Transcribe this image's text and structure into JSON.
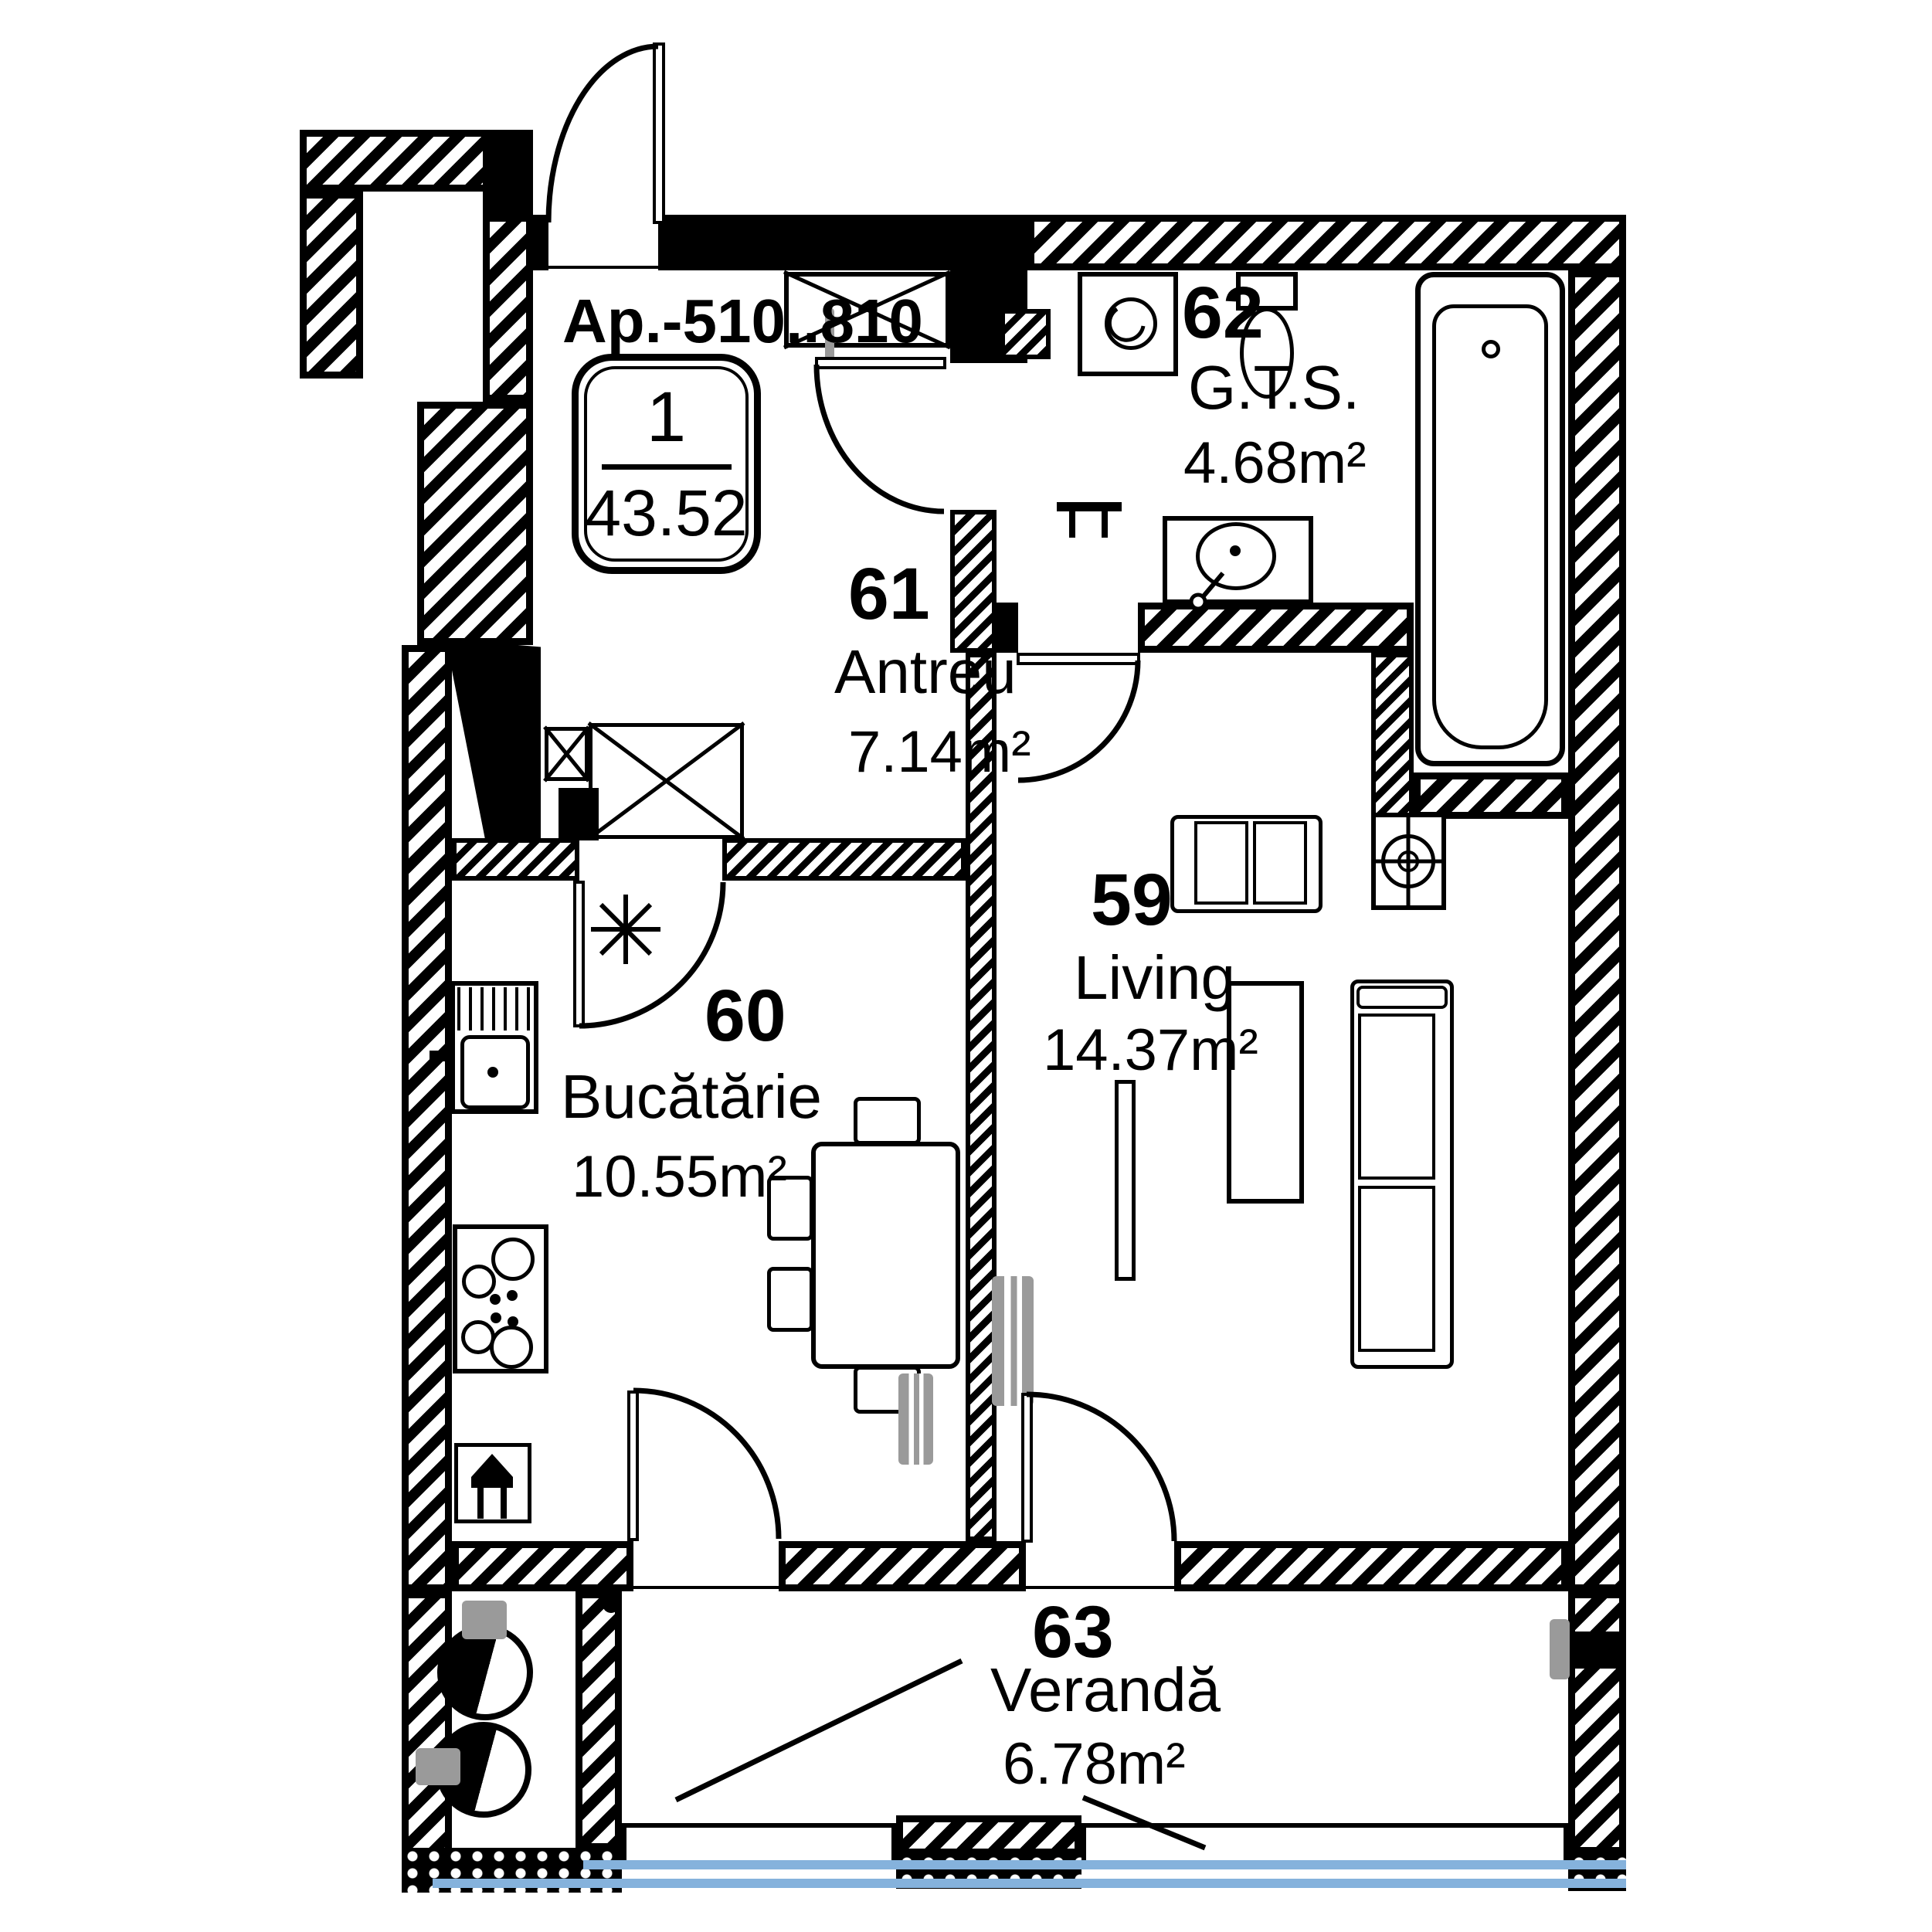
{
  "apartment": {
    "title": "Ap.-510..810",
    "badge_rooms_count": "1",
    "badge_total_area": "43.52"
  },
  "rooms": {
    "living": {
      "number": "59",
      "name": "Living",
      "area": "14.37m²"
    },
    "kitchen": {
      "number": "60",
      "name": "Bucătărie",
      "area": "10.55m²"
    },
    "hallway": {
      "number": "61",
      "name": "Antreu",
      "area": "7.14m²"
    },
    "bathroom": {
      "number": "62",
      "name": "G.T.S.",
      "area": "4.68m²"
    },
    "veranda": {
      "number": "63",
      "name": "Verandă",
      "area": "6.78m²"
    }
  },
  "icons": {
    "bathtub": "rounded-rect-css-shape",
    "toilet": "tank-and-oval-css-shape",
    "washing_machine": "square-with-circle",
    "bathroom_sink": "oval-in-counter",
    "kitchen_sink": "basin-with-drainboard",
    "stove": "four-burner-circles",
    "gas_appliance": "valve-glyph-svg",
    "kitchen_gas_point": "eight-spoke-asterisk-svg",
    "dining_table": "rect-with-chairs",
    "sofa": "rect-with-cushions",
    "coffee_table": "tall-rect",
    "equipment_box": "circled-cross-in-square",
    "radiator": "gray-bar",
    "wardrobe": "crossed-box",
    "vent_ducts": "half-filled-circles",
    "door_swing": "quarter-arc-svg",
    "window_glazing": "blue-strips"
  },
  "colors": {
    "glazing": "#85b2dc",
    "radiator": "#9a9a9a",
    "line": "#000000",
    "paper": "#ffffff"
  }
}
